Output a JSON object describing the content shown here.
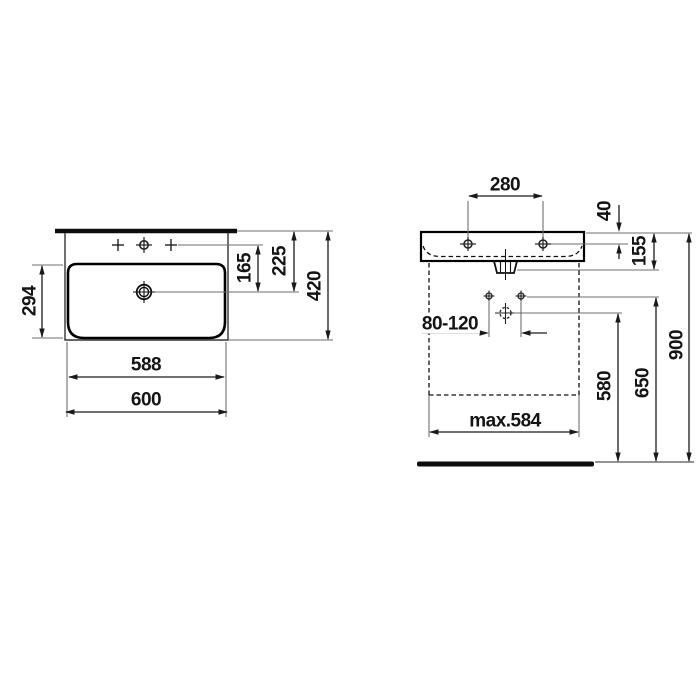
{
  "figure": {
    "kind": "washbasin installation technical drawing",
    "views": [
      "top view",
      "front view"
    ]
  },
  "dimensions": {
    "top_view": {
      "bowl_depth": "294",
      "tap_to_drain": "165",
      "rim_to_drain": "225",
      "overall_depth": "420",
      "inner_width": "588",
      "overall_width": "600"
    },
    "front_view": {
      "tap_hole_spacing": "280",
      "rim_to_tap_line": "40",
      "body_height": "155",
      "supply_spacing": "80-120",
      "drain_height": "580",
      "supply_height": "650",
      "overall_height": "900",
      "max_width_below_basin": "max.584"
    }
  },
  "symbols": {
    "tap_hole_icon": "crosshair circle",
    "optional_tap_hole_icon": "plus mark",
    "drain_icon": "double circle with crosshair",
    "supply_connection_icon": "small crosshair circle",
    "waste_pipe_icon": "dashed crosshair circle"
  },
  "colors": {
    "background": "#ffffff",
    "object_line": "#000000",
    "dimension_line": "#1a1a1a",
    "extension_line": "#6e6e6e"
  }
}
